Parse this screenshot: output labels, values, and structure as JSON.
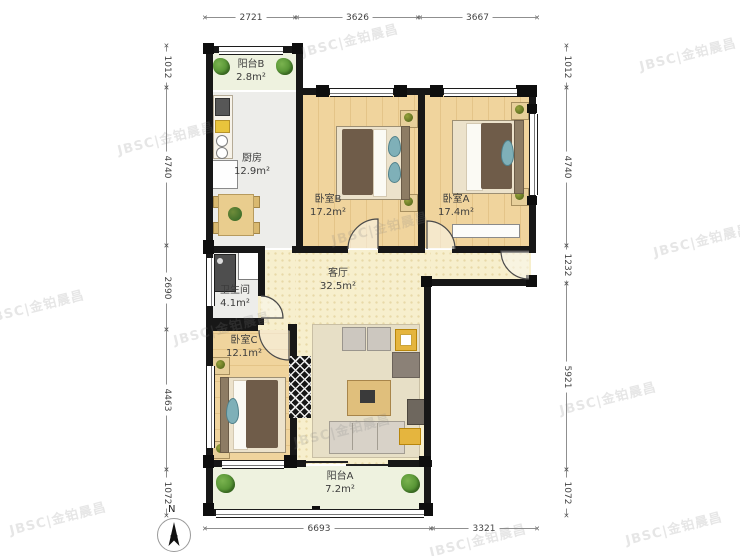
{
  "watermark": {
    "text": "JBSC|金铂晨昌"
  },
  "compass": {
    "label": "N"
  },
  "rooms": {
    "balcony_b": {
      "name": "阳台B",
      "area": "2.8m²"
    },
    "kitchen": {
      "name": "厨房",
      "area": "12.9m²"
    },
    "bedroom_b": {
      "name": "卧室B",
      "area": "17.2m²"
    },
    "bedroom_a": {
      "name": "卧室A",
      "area": "17.4m²"
    },
    "bathroom": {
      "name": "卫生间",
      "area": "4.1m²"
    },
    "living": {
      "name": "客厅",
      "area": "32.5m²"
    },
    "bedroom_c": {
      "name": "卧室C",
      "area": "12.1m²"
    },
    "balcony_a": {
      "name": "阳台A",
      "area": "7.2m²"
    }
  },
  "dimensions": {
    "top": [
      "2721",
      "3626",
      "3667"
    ],
    "bottom": [
      "6693",
      "3321"
    ],
    "left": [
      "1012",
      "4740",
      "2690",
      "4463",
      "1072"
    ],
    "right": [
      "1012",
      "4740",
      "1232",
      "5921",
      "1072"
    ]
  },
  "colors": {
    "wall": "#171717",
    "wood_floor": "#f0d49d",
    "living_floor": "#f7efcd",
    "tile_floor": "#ededea",
    "balcony_floor": "#eef2df",
    "plant_green": "#4b8a2c",
    "blanket_brown": "#6f5c49",
    "pillow_teal": "#7fb0b8"
  }
}
